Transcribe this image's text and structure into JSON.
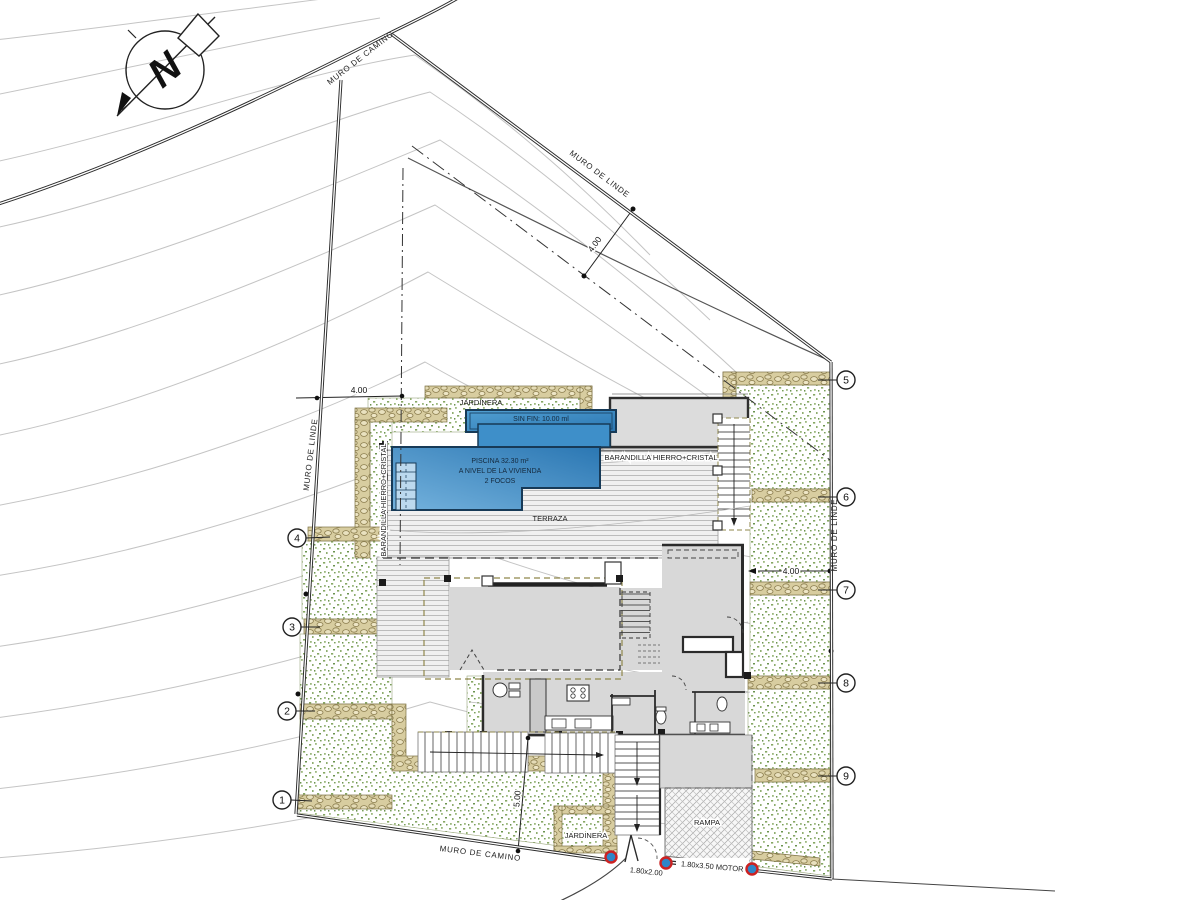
{
  "compass": {
    "north_letter": "N"
  },
  "walls": {
    "camino_top": "MURO DE CAMINO",
    "linde_topright": "MURO DE LINDE",
    "linde_left": "MURO DE LINDE",
    "linde_right": "MURO DE LINDE",
    "camino_bottom": "MURO DE CAMINO"
  },
  "dims": {
    "setback_topright": "4.00",
    "setback_left": "4.00",
    "setback_right": "4.00",
    "setback_bottom": "5.00"
  },
  "pool": {
    "sin_fin": "SIN FIN: 10.00 ml",
    "line1": "PISCINA 32.30 m²",
    "line2": "A NIVEL DE LA VIVIENDA",
    "line3": "2 FOCOS"
  },
  "labels": {
    "jardinera_top": "JARDINERA",
    "jardinera_bottom": "JARDINERA",
    "terraza": "TERRAZA",
    "rampa": "RAMPA",
    "barandilla_right": "BARANDILLA HIERRO+CRISTAL",
    "barandilla_left": "BARANDILLA HIERRO+CRISTAL",
    "gate_pedestrian": "1.80x2.00",
    "gate_motor": "1.80x3.50 MOTOR"
  },
  "markers": [
    "1",
    "2",
    "3",
    "4",
    "5",
    "6",
    "7",
    "8",
    "9"
  ],
  "colors": {
    "pool_blue": "#3584c0",
    "pool_edge": "#173a57",
    "garden_green": "#86a763",
    "wall_tan": "#d8cda0",
    "post_blue": "#2f86c8",
    "post_ring_red": "#cc2222",
    "room_gray": "#d8d8d8",
    "contour_gray": "#c4c4c4"
  }
}
